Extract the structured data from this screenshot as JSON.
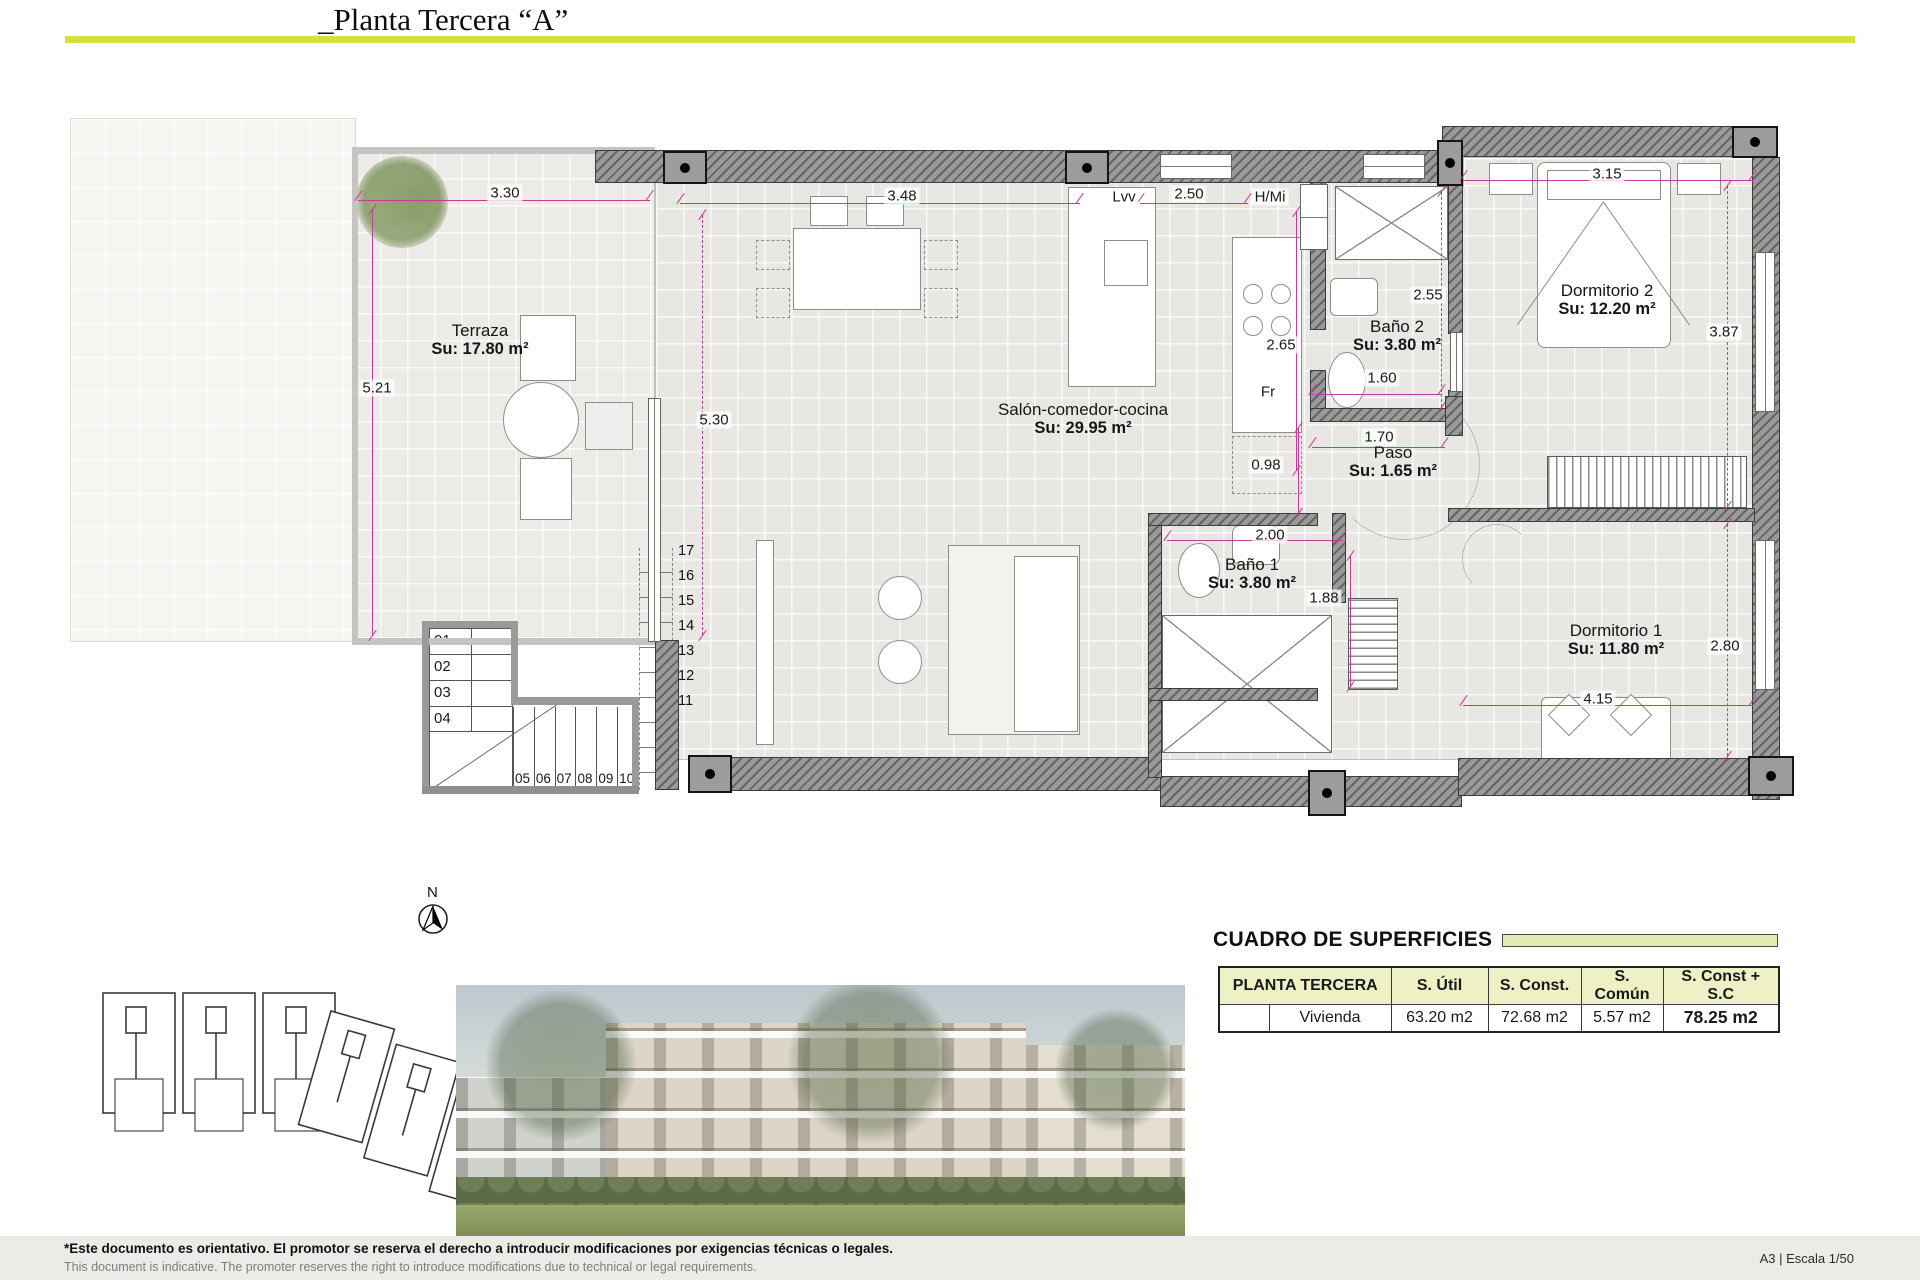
{
  "header": {
    "title": "_Planta Tercera “A”"
  },
  "colors": {
    "accent_bar": "#d7df3a",
    "dimension_lines": "#c23d94",
    "table_header_bg": "#eef0c5",
    "site_highlight": "#dde8a4",
    "wall_gray": "#9a9a9a"
  },
  "plan": {
    "north_label": "N",
    "rooms": [
      {
        "name": "Terraza",
        "area": "Su: 17.80 m²"
      },
      {
        "name": "Salón-comedor-cocina",
        "area": "Su: 29.95 m²"
      },
      {
        "name": "Baño 2",
        "area": "Su: 3.80 m²"
      },
      {
        "name": "Paso",
        "area": "Su: 1.65 m²"
      },
      {
        "name": "Baño 1",
        "area": "Su: 3.80 m²"
      },
      {
        "name": "Dormitorio 2",
        "area": "Su: 12.20 m²"
      },
      {
        "name": "Dormitorio 1",
        "area": "Su: 11.80 m²"
      }
    ],
    "dims": {
      "w_terraza": "3.30",
      "h_terraza": "5.21",
      "w_salon": "3.48",
      "lvv": "Lvv",
      "w_cocina": "2.50",
      "hmi": "H/Mi",
      "h_bano2": "2.55",
      "h_cocina": "2.65",
      "w_bano2": "1.60",
      "fr": "Fr",
      "w_paso": "1.70",
      "h_paso": "0.98",
      "w_bano1": "2.00",
      "h_bano1": "1.88",
      "h_salon": "5.30",
      "w_dorm2": "3.15",
      "h_dorm2": "3.87",
      "h_dorm1": "2.80",
      "w_dorm1": "4.15"
    },
    "stairs": {
      "flight1": [
        "01",
        "02",
        "03",
        "04"
      ],
      "flight2": [
        "05",
        "06",
        "07",
        "08",
        "09",
        "10"
      ],
      "flight3": [
        "11",
        "12",
        "13",
        "14",
        "15",
        "16",
        "17"
      ]
    }
  },
  "surfaces": {
    "title": "CUADRO DE SUPERFICIES",
    "columns": [
      "PLANTA TERCERA",
      "S. Útil",
      "S. Const.",
      "S. Común",
      "S. Const + S.C"
    ],
    "row_label": "Vivienda",
    "values": {
      "util": "63.20 m2",
      "construida": "72.68 m2",
      "comun": "5.57 m2",
      "total": "78.25 m2"
    }
  },
  "footer": {
    "line1": "*Este documento es orientativo. El promotor se reserva el derecho a introducir modificaciones por exigencias técnicas o legales.",
    "line2": "This document is indicative. The promoter reserves the right to introduce modifications due to technical or legal requirements.",
    "scale": "A3 | Escala 1/50"
  }
}
